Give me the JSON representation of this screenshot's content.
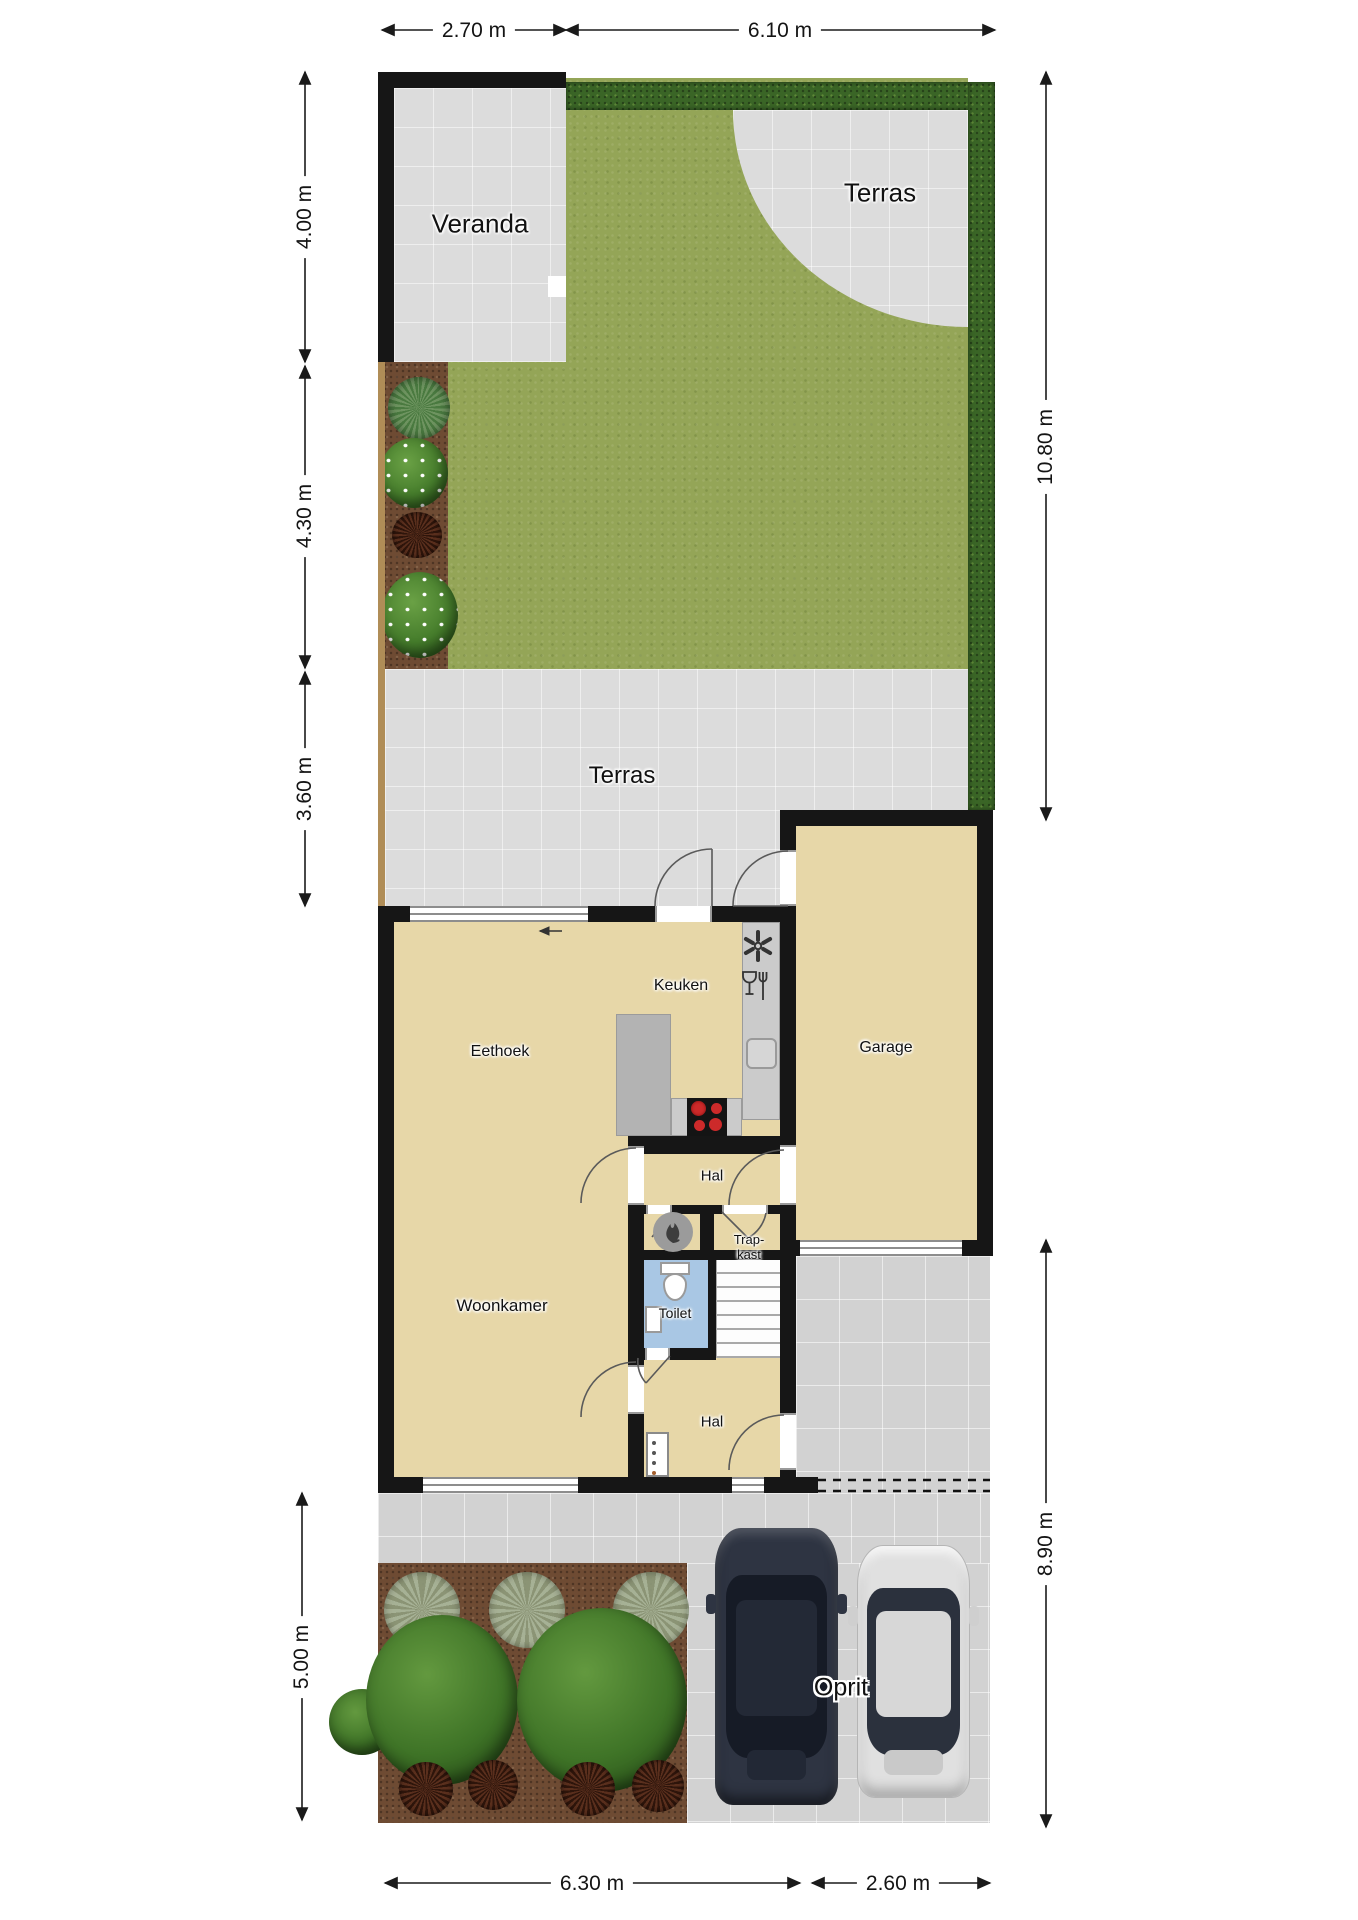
{
  "title": "Begane grond plattegrond met tuin",
  "labels": {
    "veranda": "Veranda",
    "terras_top": "Terras",
    "terras_mid": "Terras",
    "keuken": "Keuken",
    "eethoek": "Eethoek",
    "garage": "Garage",
    "hal_mid": "Hal",
    "trapkast_l1": "Trap-",
    "trapkast_l2": "kast",
    "toilet": "Toilet",
    "woonkamer": "Woonkamer",
    "hal_entry": "Hal",
    "oprit": "Oprit"
  },
  "dimensions": {
    "top_left": "2.70 m",
    "top_right": "6.10 m",
    "left_1": "4.00 m",
    "left_2": "4.30 m",
    "left_3": "3.60 m",
    "left_4": "5.00 m",
    "right_1": "10.80 m",
    "right_2": "8.90 m",
    "bottom_1": "6.30 m",
    "bottom_2": "2.60 m"
  },
  "icons": {
    "extractor": "extractor-fan-icon",
    "cutlery": "glass-and-fork-icon",
    "flame": "heater-flame-icon",
    "stove": "cooktop-4-burners",
    "sink": "kitchen-sink",
    "toilet": "toilet-bowl",
    "hand_basin": "hand-basin"
  },
  "colors": {
    "wall": "#161616",
    "floor": "#e7d7a8",
    "tile": "#dcdcdc",
    "tile_dark": "#d2d2d2",
    "grass": "#94a557",
    "hedge": "#3a6526",
    "soil": "#6e4b33",
    "toilet_floor": "#a9c7e4",
    "counter": "#cbcbcb",
    "island": "#b3b3b3",
    "burner": "#cd2a2a",
    "car_dark": "#2e3442",
    "car_light": "#e0e0e0",
    "fence": "#b08d57",
    "dim_line": "#1a1a1a"
  }
}
